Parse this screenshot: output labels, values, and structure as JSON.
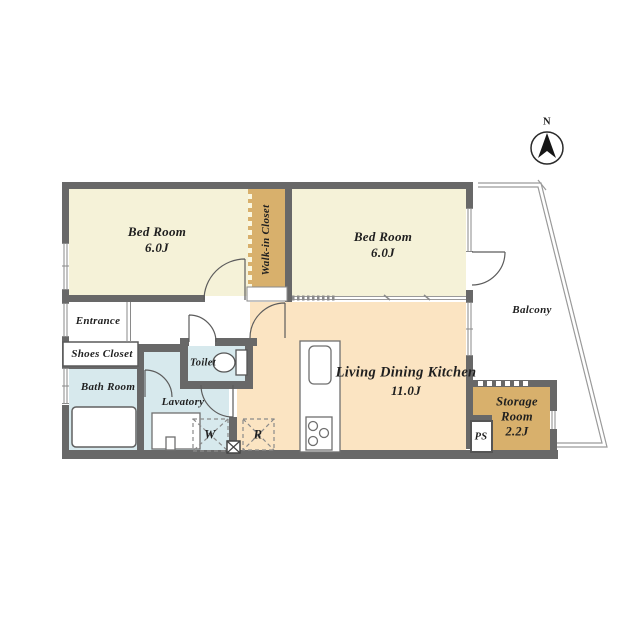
{
  "compass": {
    "north_label": "N"
  },
  "rooms": {
    "bedroom_top_left": {
      "name": "Bed Room",
      "size": "6.0J"
    },
    "bedroom_top_right": {
      "name": "Bed Room",
      "size": "6.0J"
    },
    "walk_in_closet": {
      "name": "Walk-in Closet"
    },
    "living_dining_kitchen": {
      "name": "Living Dining Kitchen",
      "size": "11.0J"
    },
    "balcony": {
      "name": "Balcony"
    },
    "entrance": {
      "name": "Entrance"
    },
    "shoes_closet": {
      "name": "Shoes Closet"
    },
    "bath_room": {
      "name": "Bath Room"
    },
    "toilet": {
      "name": "Toilet"
    },
    "lavatory": {
      "name": "Lavatory"
    },
    "storage_room": {
      "line1": "Storage",
      "line2": "Room",
      "size": "2.2J"
    },
    "pipe_space": {
      "abbr": "PS"
    },
    "washer": {
      "abbr": "W"
    },
    "refrigerator": {
      "abbr": "R"
    }
  },
  "colors": {
    "bedroom": "#f5f2d8",
    "closet_tan": "#d8b06c",
    "ldk_peach": "#fbe4c2",
    "wet_blue": "#d7e9ed",
    "wall_gray": "#686868",
    "outline_gray": "#9a9a9a",
    "fixture_stroke": "#6f6f6f",
    "text": "#1f1f1f",
    "white": "#ffffff"
  }
}
